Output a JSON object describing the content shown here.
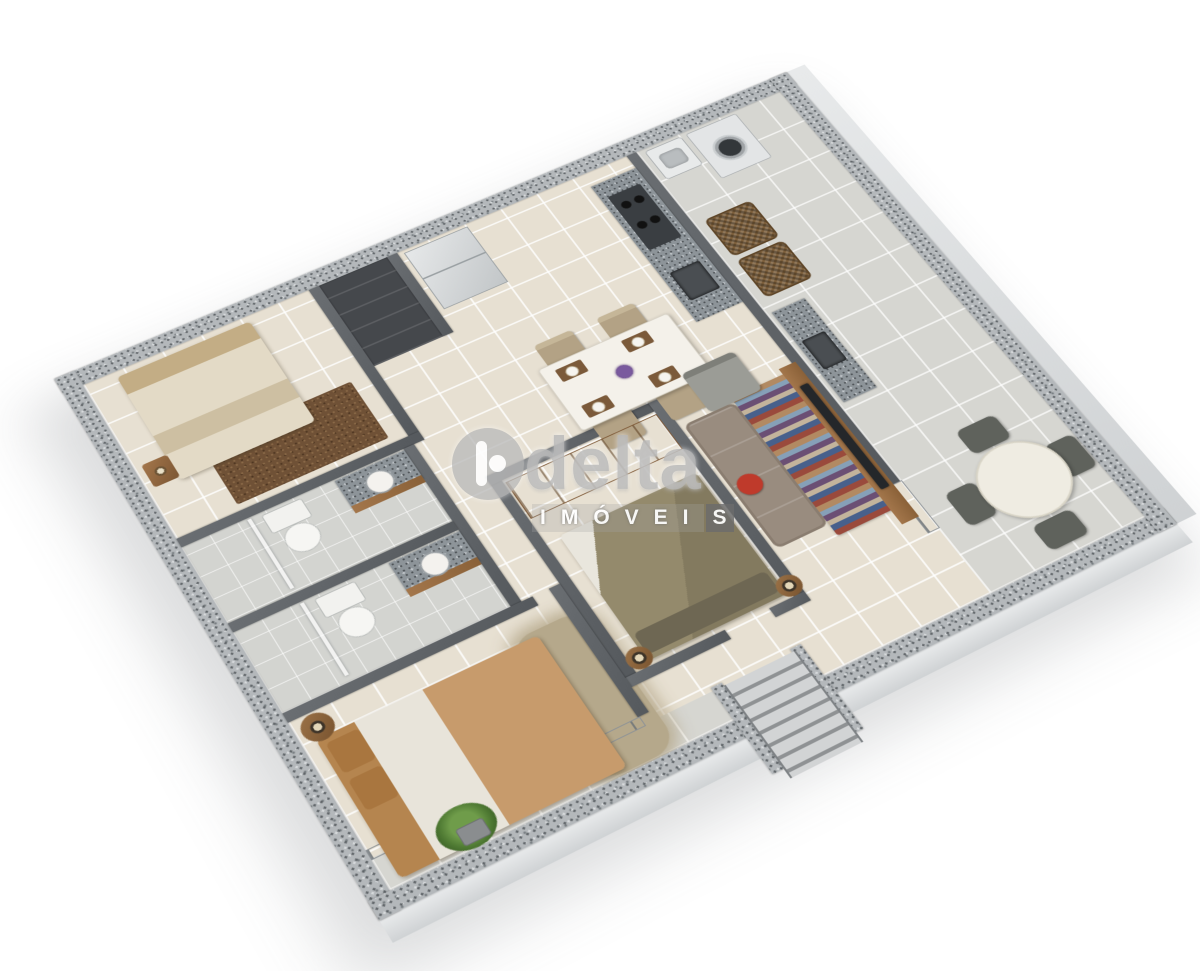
{
  "page": {
    "background": "#ffffff"
  },
  "watermark": {
    "brand": "delta",
    "subtitle_full": "IMÓVEIS",
    "subtitle_main": "IMÓVEI",
    "subtitle_last": "S",
    "colors": {
      "brand_text": "#b9b9b9",
      "subtitle_text": "#ffffff",
      "subtitle_box": "#6c6c6c",
      "logo_circle": "#bbbbbb"
    }
  },
  "scene": {
    "type": "isometric-3d-floorplan-render",
    "description": "Bird's-eye 3D rendering of an apartment floor plan with speckled granite outer walls, cream tiled floors and furnished rooms",
    "rooms": [
      {
        "id": "bedroom-1",
        "position": "top-left"
      },
      {
        "id": "closet",
        "position": "top-center-left"
      },
      {
        "id": "kitchen",
        "position": "top-center"
      },
      {
        "id": "laundry-area",
        "position": "top-right-corner"
      },
      {
        "id": "dining-area",
        "position": "center-top"
      },
      {
        "id": "bathroom-1",
        "position": "left"
      },
      {
        "id": "bathroom-2",
        "position": "left-lower"
      },
      {
        "id": "suite-bedroom",
        "position": "center"
      },
      {
        "id": "living-room",
        "position": "center-right"
      },
      {
        "id": "balcony",
        "position": "right-strip"
      },
      {
        "id": "bedroom-2",
        "position": "bottom-left"
      },
      {
        "id": "garden-balcony",
        "position": "bottom-left-strip"
      },
      {
        "id": "entry-steps",
        "position": "bottom-center"
      }
    ],
    "furniture": [
      "double-bed-cream",
      "brown-rug",
      "nightstand-lamp",
      "fridge",
      "stove-counter",
      "kitchen-sink",
      "laundry-tank-sink",
      "washing-machine",
      "dining-table-4-chairs",
      "flower-centerpiece",
      "toilet",
      "vanity-granite-sink",
      "shower",
      "wardrobe",
      "double-bed-olive",
      "bedside-lamps",
      "armchair-gray",
      "sofa-taupe",
      "red-cushion",
      "striped-rug",
      "tv-wood-panel",
      "wicker-armchair-pair",
      "balcony-counter-sink",
      "round-table-4-chairs",
      "double-bed-caramel",
      "shaggy-rug",
      "floor-lamp",
      "potted-plant",
      "sliding-glass-doors",
      "entry-staircase"
    ],
    "palette": {
      "floor_cream": "#e7e0d2",
      "floor_balcony": "#d6d6d1",
      "floor_bath": "#d3d4d0",
      "wall_dark": "#55595d",
      "wall_speckle": "#b4b8bb",
      "granite": "#8d9499",
      "wood": "#a3764b",
      "bed_cream": "#cdbfa2",
      "bed_olive": "#837a5f",
      "bed_caramel": "#b5854f",
      "rug_brown": "#6f5136",
      "rug_shag": "#b5a88b",
      "sofa": "#998c7f",
      "cushion_red": "#bf3a2b",
      "chair_beige": "#b3a285",
      "chair_dark": "#5f625c",
      "wicker": "#7d5f3b",
      "plant": "#6f9c4a",
      "fridge": "#c2c6c8",
      "tv": "#24272a"
    }
  }
}
